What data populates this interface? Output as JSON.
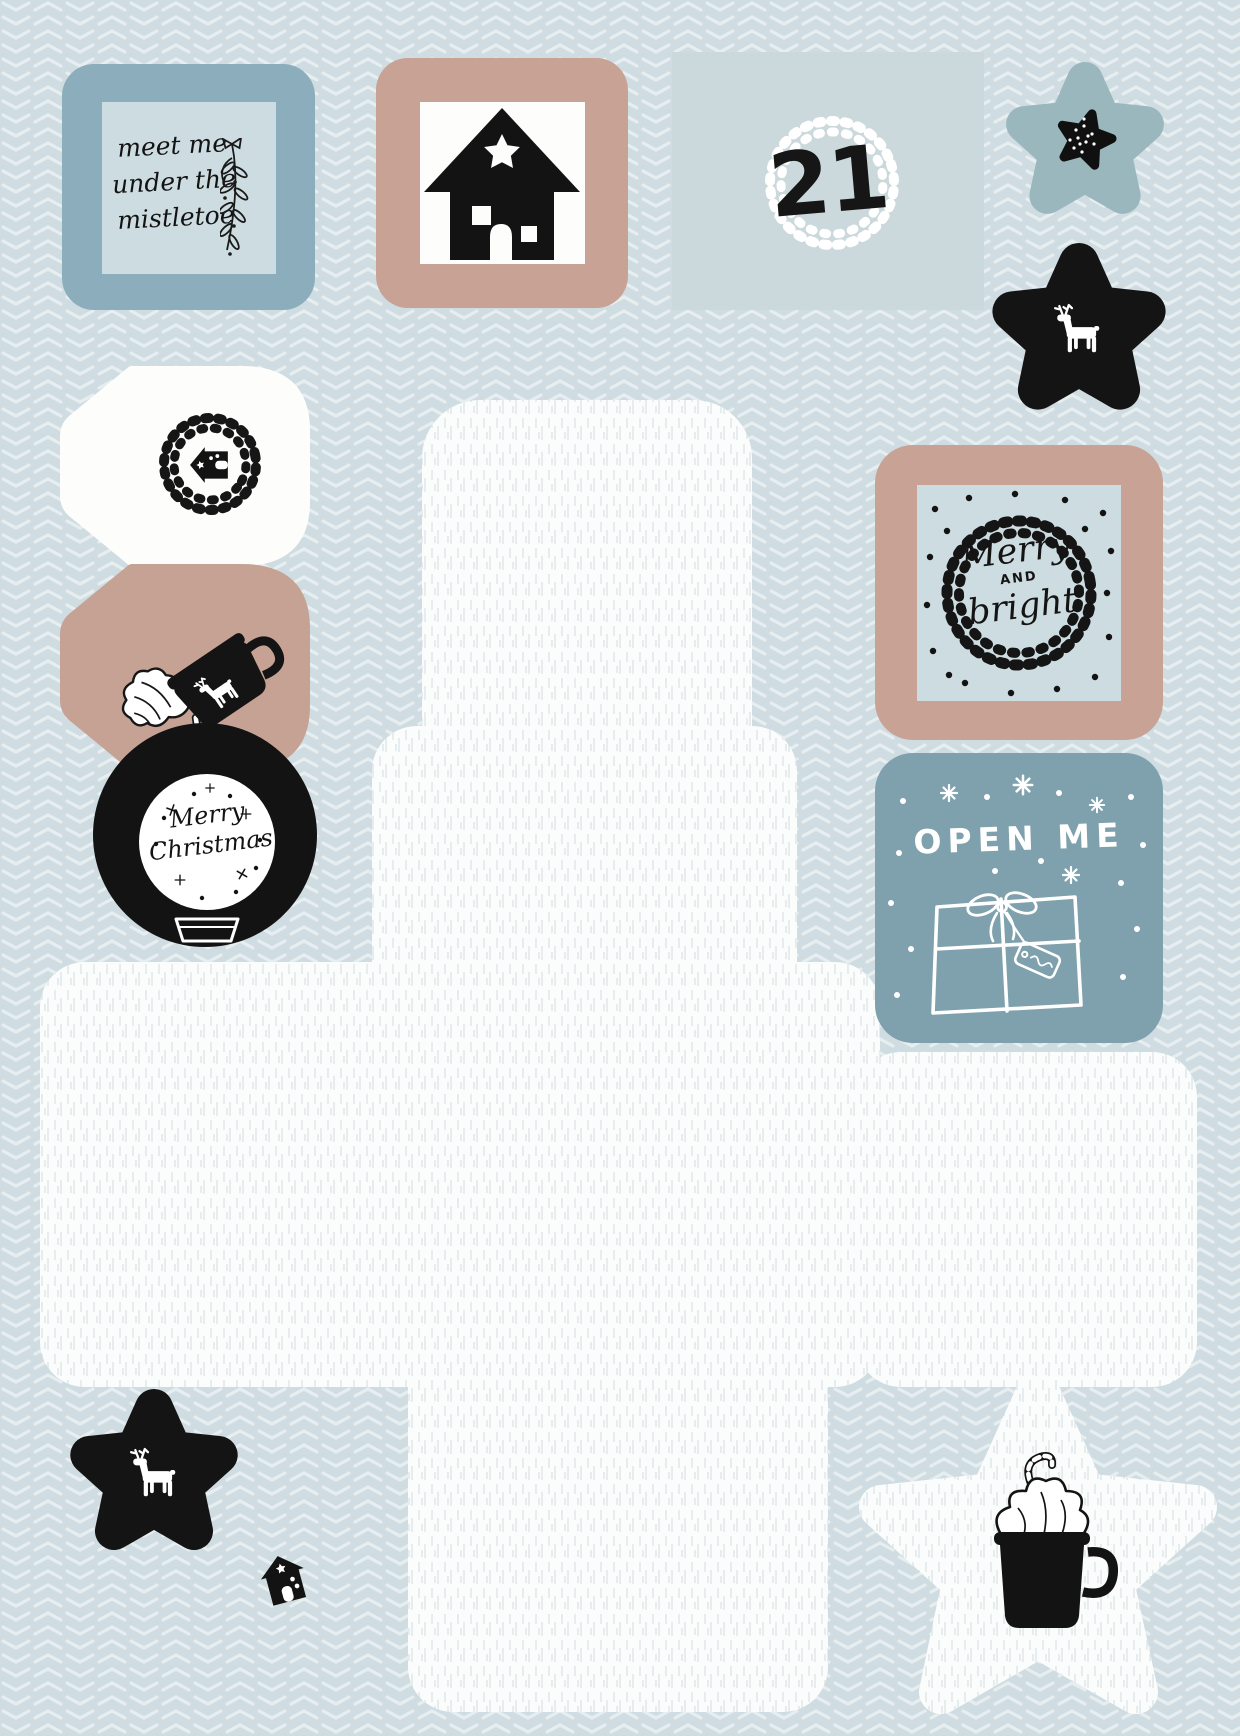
{
  "canvas": {
    "width": 1240,
    "height": 1736
  },
  "palette": {
    "background": "#cfdce1",
    "chevron_pattern": "#ffffff",
    "plain_patch": "#cbd8dc",
    "frame_dusty_blue": "#8cadbb",
    "inner_pale_blue": "#cddce1",
    "frame_tan": "#c7a295",
    "tag_tan": "#c5a294",
    "tile_teal": "#7ea1ad",
    "puffy_star_blue": "#9bb7be",
    "ink_black": "#131313",
    "cutout_paper_white": "#fbfcfc"
  },
  "stickers": {
    "mistletoe": {
      "lines": [
        "meet me",
        "under the",
        "mistletoe"
      ]
    },
    "day": {
      "number": "21"
    },
    "merry_bright": {
      "word1": "Merry",
      "word2": "AND",
      "word3": "bright"
    },
    "open_me": {
      "label": "OPEN ME"
    },
    "snow_globe": {
      "word1": "Merry",
      "word2": "Christmas"
    }
  }
}
